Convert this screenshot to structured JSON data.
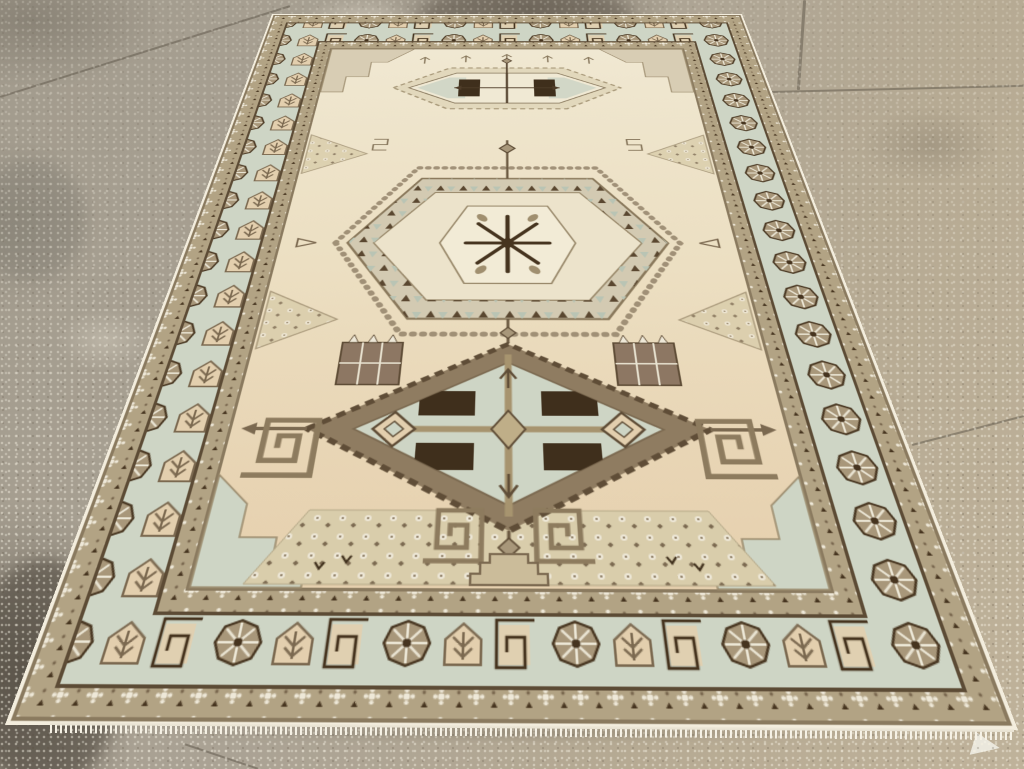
{
  "scene": {
    "description": "A vintage cream, tan and brown geometric tribal area rug with three stacked medallions, photographed at an angle lying on a speckled beige stone-tile showroom floor with a white knotted fringe at its lower edge."
  },
  "palette": {
    "floor_base": "#a29b8d",
    "floor_warm": "#bfb29a",
    "grout": "#857d6e",
    "selvedge": "#f3eddd",
    "fringe": "#f6f2e6",
    "outline_dark": "#5c4b35",
    "outline_mid": "#8a7a5f",
    "field_top": "#f0e8d2",
    "field_bottom": "#e6d0ae",
    "celadon": "#ced5c5",
    "guard_ground": "#b2a384",
    "taupe": "#a8977a",
    "brown": "#7b6950",
    "espresso": "#46341f",
    "dark_block": "#3f2f1c",
    "peach": "#e3cfae",
    "motif_white": "#eee8d8",
    "medallion_tan": "#d3cab2",
    "medallion_cream": "#ece3cb"
  },
  "rug": {
    "parts": {
      "floor": "speckled stone tile floor",
      "rug": "vintage geometric tribal rug",
      "outer_guard": "outer guard border with white rosettes",
      "main_border": "main border with wheel rosettes, latch-hooks and pentagon trees",
      "inner_guard": "inner guard border",
      "field": "cream field",
      "top_medallion": "serrated lozenge medallion",
      "central_medallion": "hexagonal medallion with starburst center",
      "lower_medallion": "latch-hook diamond medallion with dark blocks",
      "meanders": "greek-key meander hooks",
      "flower_panel": "dotted blossom panel",
      "fringe": "white knotted fringe"
    }
  }
}
